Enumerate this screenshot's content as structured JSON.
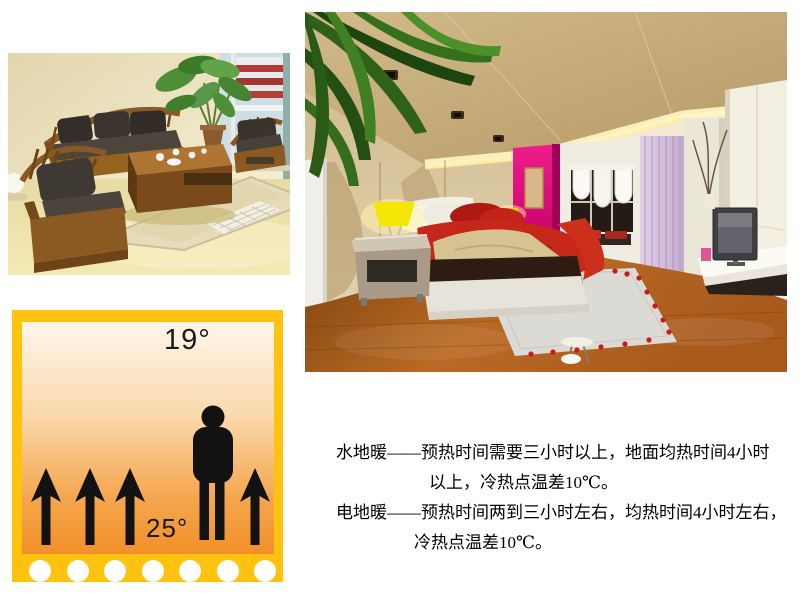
{
  "theme": {
    "diagram_border": "#FFC20E",
    "diagram_gradient_top": "#FEF5EB",
    "diagram_gradient_bottom": "#F19027",
    "ink": "#111111",
    "accent_magenta": "#E00F7E",
    "floor_brown": "#A85A1D"
  },
  "diagram": {
    "air_temperature": "19°",
    "floor_temperature": "25°",
    "arrow_count": 4,
    "dot_count": 7
  },
  "description": {
    "line1": "水地暖——预热时间需要三小时以上，地面均热时间4小时",
    "line2": "以上，冷热点温差10℃。",
    "line3": "电地暖——预热时间两到三小时左右，均热时间4小时左右，",
    "line4": "冷热点温差10℃。"
  }
}
